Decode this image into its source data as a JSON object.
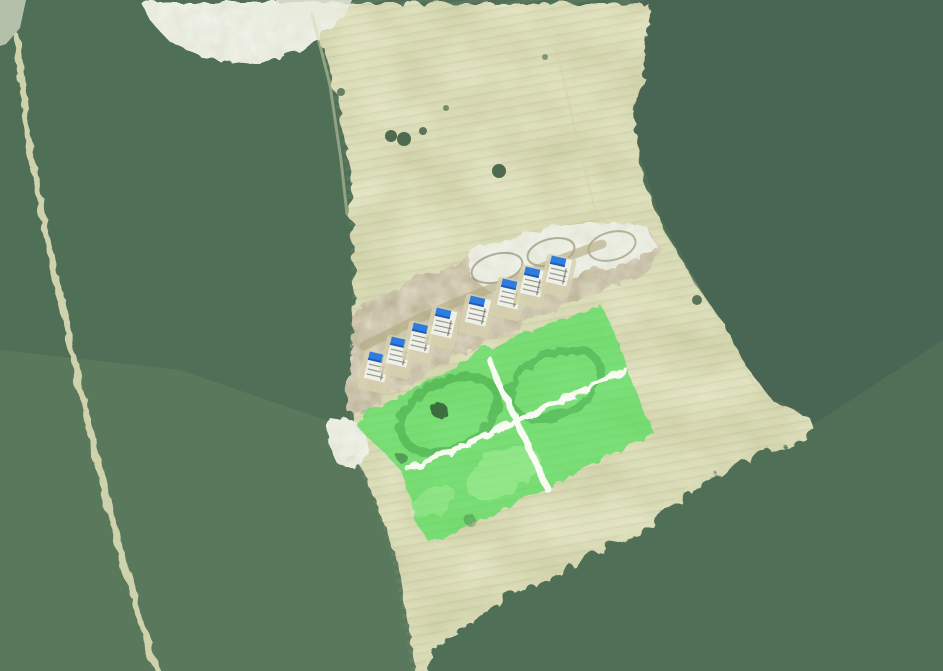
{
  "meta": {
    "view": "aerial-satellite-map",
    "canvas_width": 943,
    "canvas_height": 671
  },
  "palette": {
    "forest_base": "#4f6f57",
    "forest_shadow": "#2e3c49",
    "forest_light": "#93b585",
    "field": "#b0b375",
    "dirt": "#9c8f6b",
    "pale_sand": "#d1d6bf",
    "forest_road": "#d6d8b2",
    "parcel_highlight": "#37e04a",
    "parcel_road_white": "#fdfdf8",
    "house_body": "#eff0e9",
    "house_tarp_blue": "#2d7ce1",
    "house_pad": "#d7d1b0"
  },
  "house_style": {
    "rotation_deg": 13,
    "body_w": 21,
    "body_h": 27,
    "tarp_w": 15,
    "tarp_h": 8.5,
    "pad_w": 30,
    "pad_h": 40,
    "body_fill": "#eff0e9",
    "tarp_fill": "#2d7ce1",
    "tarp_edge": "#1d4f9e",
    "pad_fill": "#d7d1b0",
    "frame_line": "#9a9a8e",
    "dark_line": "#6f6f63"
  },
  "scene": [
    {
      "name": "forest-base",
      "kind": "rect",
      "x": 0,
      "y": 0,
      "w": 943,
      "h": 671,
      "filter": "forestTex",
      "interactable": false
    },
    {
      "name": "forest-tint-northeast",
      "kind": "poly",
      "fill": "rgba(38,56,74,0.15)",
      "interactable": false,
      "points": [
        [
          630,
          0
        ],
        [
          943,
          0
        ],
        [
          943,
          340
        ],
        [
          808,
          428
        ],
        [
          762,
          396
        ],
        [
          716,
          316
        ],
        [
          660,
          216
        ],
        [
          628,
          120
        ],
        [
          638,
          60
        ]
      ]
    },
    {
      "name": "forest-tint-southwest",
      "kind": "poly",
      "fill": "rgba(175,195,135,0.12)",
      "interactable": false,
      "points": [
        [
          0,
          350
        ],
        [
          180,
          370
        ],
        [
          340,
          425
        ],
        [
          400,
          520
        ],
        [
          425,
          671
        ],
        [
          0,
          671
        ]
      ]
    },
    {
      "name": "farm-field",
      "kind": "poly",
      "filter": "fieldTex",
      "clip_id": "fieldClip",
      "interactable": false,
      "points": [
        [
          296,
          0
        ],
        [
          316,
          36
        ],
        [
          334,
          96
        ],
        [
          344,
          156
        ],
        [
          349,
          216
        ],
        [
          352,
          286
        ],
        [
          349,
          356
        ],
        [
          350,
          424
        ],
        [
          348,
          442
        ],
        [
          372,
          498
        ],
        [
          390,
          548
        ],
        [
          400,
          600
        ],
        [
          407,
          640
        ],
        [
          411,
          671
        ],
        [
          424,
          671
        ],
        [
          430,
          645
        ],
        [
          458,
          622
        ],
        [
          505,
          592
        ],
        [
          553,
          570
        ],
        [
          612,
          541
        ],
        [
          650,
          521
        ],
        [
          668,
          505
        ],
        [
          692,
          483
        ],
        [
          726,
          464
        ],
        [
          757,
          450
        ],
        [
          790,
          440
        ],
        [
          815,
          430
        ],
        [
          806,
          414
        ],
        [
          768,
          396
        ],
        [
          740,
          360
        ],
        [
          718,
          317
        ],
        [
          686,
          272
        ],
        [
          664,
          232
        ],
        [
          650,
          205
        ],
        [
          636,
          158
        ],
        [
          630,
          120
        ],
        [
          640,
          72
        ],
        [
          645,
          0
        ]
      ]
    },
    {
      "name": "crop-rows-texture",
      "kind": "rect",
      "x": 0,
      "y": 0,
      "w": 943,
      "h": 671,
      "fill": "url(#cropRows)",
      "clip": "fieldClip",
      "interactable": false
    },
    {
      "name": "sand-clearing",
      "kind": "poly",
      "filter": "paleTex",
      "interactable": false,
      "points": [
        [
          138,
          0
        ],
        [
          342,
          0
        ],
        [
          332,
          22
        ],
        [
          300,
          48
        ],
        [
          258,
          62
        ],
        [
          204,
          57
        ],
        [
          166,
          38
        ],
        [
          146,
          16
        ]
      ]
    },
    {
      "name": "sand-clearing-bright",
      "kind": "poly",
      "fill": "#e9ebdc",
      "opacity": 0.85,
      "interactable": false,
      "points": [
        [
          276,
          0
        ],
        [
          352,
          0
        ],
        [
          344,
          18
        ],
        [
          300,
          30
        ],
        [
          276,
          12
        ]
      ]
    },
    {
      "name": "sand-corner",
      "kind": "poly",
      "fill": "#dfe3cc",
      "opacity": 0.7,
      "interactable": false,
      "points": [
        [
          0,
          0
        ],
        [
          26,
          0
        ],
        [
          20,
          28
        ],
        [
          6,
          44
        ],
        [
          0,
          46
        ]
      ]
    },
    {
      "name": "field-margin-path-west",
      "kind": "line",
      "stroke": "#d4d7ae",
      "w": 3,
      "opacity": 0.5,
      "interactable": false,
      "points": [
        [
          312,
          14
        ],
        [
          330,
          85
        ],
        [
          341,
          160
        ],
        [
          347,
          214
        ]
      ]
    },
    {
      "name": "field-margin-path-east",
      "kind": "line",
      "stroke": "#d0d4a8",
      "w": 2.5,
      "opacity": 0.45,
      "interactable": false,
      "points": [
        [
          652,
          212
        ],
        [
          686,
          270
        ],
        [
          716,
          316
        ],
        [
          754,
          384
        ],
        [
          798,
          434
        ]
      ]
    },
    {
      "name": "construction-access-path",
      "kind": "line",
      "stroke": "#cfd2a6",
      "w": 2.5,
      "opacity": 0.4,
      "interactable": false,
      "points": [
        [
          556,
          48
        ],
        [
          577,
          138
        ],
        [
          596,
          214
        ],
        [
          628,
          238
        ]
      ]
    },
    {
      "name": "forest-dirt-road",
      "kind": "line",
      "stroke": "#d6d8b2",
      "w": 6.5,
      "opacity": 0.95,
      "filter": "roughen",
      "interactable": false,
      "points": [
        [
          14,
          34
        ],
        [
          28,
          150
        ],
        [
          47,
          245
        ],
        [
          67,
          335
        ],
        [
          87,
          425
        ],
        [
          110,
          520
        ],
        [
          132,
          595
        ],
        [
          150,
          655
        ],
        [
          157,
          671
        ]
      ]
    },
    {
      "name": "construction-site-dirt",
      "kind": "poly",
      "filter": "dirtTex",
      "interactable": false,
      "points": [
        [
          352,
          306
        ],
        [
          400,
          282
        ],
        [
          450,
          262
        ],
        [
          504,
          244
        ],
        [
          556,
          230
        ],
        [
          600,
          223
        ],
        [
          644,
          225
        ],
        [
          660,
          246
        ],
        [
          648,
          268
        ],
        [
          606,
          285
        ],
        [
          556,
          305
        ],
        [
          500,
          332
        ],
        [
          446,
          358
        ],
        [
          400,
          384
        ],
        [
          366,
          408
        ],
        [
          348,
          413
        ],
        [
          344,
          396
        ],
        [
          348,
          356
        ],
        [
          350,
          324
        ]
      ]
    },
    {
      "name": "construction-work-area",
      "kind": "poly",
      "filter": "paleTex",
      "interactable": false,
      "points": [
        [
          468,
          248
        ],
        [
          512,
          234
        ],
        [
          560,
          224
        ],
        [
          610,
          220
        ],
        [
          646,
          226
        ],
        [
          656,
          246
        ],
        [
          620,
          262
        ],
        [
          574,
          273
        ],
        [
          528,
          285
        ],
        [
          488,
          290
        ],
        [
          466,
          272
        ]
      ]
    },
    {
      "name": "vehicle-track-loop",
      "kind": "ring",
      "cx": 497,
      "cy": 268,
      "rx": 26,
      "ry": 14,
      "rot": -15,
      "stroke": "rgba(118,108,74,0.5)",
      "w": 2,
      "interactable": false
    },
    {
      "name": "vehicle-track-loop",
      "kind": "ring",
      "cx": 551,
      "cy": 252,
      "rx": 24,
      "ry": 13,
      "rot": -15,
      "stroke": "rgba(118,108,74,0.5)",
      "w": 2,
      "interactable": false
    },
    {
      "name": "vehicle-track-loop",
      "kind": "ring",
      "cx": 612,
      "cy": 246,
      "rx": 24,
      "ry": 14,
      "rot": -15,
      "stroke": "rgba(118,108,74,0.45)",
      "w": 2,
      "interactable": false
    },
    {
      "name": "construction-street",
      "kind": "line",
      "stroke": "#b3a87e",
      "w": 9,
      "opacity": 0.6,
      "interactable": false,
      "points": [
        [
          364,
          346
        ],
        [
          420,
          318
        ],
        [
          472,
          296
        ],
        [
          522,
          276
        ],
        [
          564,
          258
        ],
        [
          602,
          244
        ]
      ]
    },
    {
      "name": "house",
      "kind": "house",
      "cx": 377,
      "cy": 367,
      "interactable": false
    },
    {
      "name": "house",
      "kind": "house",
      "cx": 399,
      "cy": 352,
      "interactable": false
    },
    {
      "name": "house",
      "kind": "house",
      "cx": 421,
      "cy": 338,
      "interactable": false
    },
    {
      "name": "house",
      "kind": "house",
      "cx": 444,
      "cy": 323,
      "interactable": false
    },
    {
      "name": "house",
      "kind": "house",
      "cx": 478,
      "cy": 311,
      "interactable": false
    },
    {
      "name": "house",
      "kind": "house",
      "cx": 510,
      "cy": 294,
      "interactable": false
    },
    {
      "name": "house",
      "kind": "house",
      "cx": 533,
      "cy": 282,
      "interactable": false
    },
    {
      "name": "house",
      "kind": "house",
      "cx": 559,
      "cy": 271,
      "interactable": false
    },
    {
      "name": "west-dirt-patch",
      "kind": "poly",
      "filter": "paleTex",
      "interactable": false,
      "points": [
        [
          326,
          414
        ],
        [
          352,
          418
        ],
        [
          364,
          432
        ],
        [
          368,
          452
        ],
        [
          352,
          466
        ],
        [
          334,
          460
        ],
        [
          325,
          436
        ]
      ]
    },
    {
      "name": "site-container",
      "kind": "box",
      "x": 333,
      "y": 446,
      "w": 9,
      "h": 5,
      "rot": -20,
      "fill": "#e9e7d8",
      "interactable": false
    },
    {
      "name": "site-container",
      "kind": "box",
      "x": 346,
      "y": 456,
      "w": 9,
      "h": 5,
      "rot": -20,
      "fill": "#e4e2d2",
      "interactable": false
    },
    {
      "name": "highlighted-parcel",
      "kind": "group",
      "filter": "roughen",
      "interactable": true,
      "children": [
        {
          "name": "parcel-highlight-fill",
          "kind": "poly",
          "fill": "#37e04a",
          "opacity": 0.6,
          "interactable": false,
          "points": [
            [
              371,
              407
            ],
            [
              424,
              379
            ],
            [
              476,
              351
            ],
            [
              524,
              330
            ],
            [
              572,
              312
            ],
            [
              598,
              302
            ],
            [
              612,
              330
            ],
            [
              634,
              390
            ],
            [
              652,
              431
            ],
            [
              601,
              457
            ],
            [
              548,
              484
            ],
            [
              494,
              510
            ],
            [
              438,
              536
            ],
            [
              425,
              538
            ],
            [
              414,
              520
            ],
            [
              407,
              492
            ],
            [
              398,
              468
            ],
            [
              384,
              452
            ],
            [
              362,
              432
            ],
            [
              354,
              423
            ],
            [
              360,
              414
            ]
          ]
        },
        {
          "name": "parcel-grass-patch",
          "kind": "ellipse",
          "cx": 500,
          "cy": 470,
          "rx": 40,
          "ry": 22,
          "rot": -27,
          "fill": "rgba(215,255,190,0.28)",
          "interactable": false
        },
        {
          "name": "parcel-grass-patch",
          "kind": "ellipse",
          "cx": 430,
          "cy": 500,
          "rx": 25,
          "ry": 14,
          "rot": -27,
          "fill": "rgba(215,255,190,0.22)",
          "interactable": false
        },
        {
          "name": "parcel-ground-ring",
          "kind": "ring",
          "cx": 447,
          "cy": 412,
          "rx": 52,
          "ry": 33,
          "rot": -27,
          "stroke": "rgba(35,125,45,0.32)",
          "w": 9,
          "interactable": false
        },
        {
          "name": "parcel-ground-ring",
          "kind": "ring",
          "cx": 553,
          "cy": 382,
          "rx": 48,
          "ry": 30,
          "rot": -27,
          "stroke": "rgba(35,125,45,0.30)",
          "w": 8,
          "interactable": false
        },
        {
          "name": "parcel-tree",
          "kind": "circle",
          "cx": 437,
          "cy": 408,
          "r": 8,
          "fill": "#2f5c36",
          "opacity": 0.85,
          "interactable": false
        },
        {
          "name": "parcel-shrub",
          "kind": "circle",
          "cx": 400,
          "cy": 456,
          "r": 5,
          "fill": "#2f5c36",
          "opacity": 0.5,
          "interactable": false
        },
        {
          "name": "parcel-shrub",
          "kind": "circle",
          "cx": 468,
          "cy": 518,
          "r": 6,
          "fill": "#3a6b40",
          "opacity": 0.35,
          "interactable": false
        },
        {
          "name": "parcel-road-northeast",
          "kind": "line",
          "stroke": "#fdfdf8",
          "w": 6.5,
          "opacity": 0.96,
          "interactable": false,
          "points": [
            [
              622,
              368
            ],
            [
              408,
              468
            ]
          ]
        },
        {
          "name": "parcel-road-southeast",
          "kind": "line",
          "stroke": "#fdfdf8",
          "w": 6.5,
          "opacity": 0.96,
          "interactable": false,
          "points": [
            [
              487,
              357
            ],
            [
              545,
              487
            ]
          ]
        }
      ]
    },
    {
      "name": "field-tree",
      "kind": "circle",
      "cx": 391,
      "cy": 136,
      "r": 6,
      "fill": "#3c5a41",
      "opacity": 0.88,
      "interactable": false
    },
    {
      "name": "field-tree",
      "kind": "circle",
      "cx": 404,
      "cy": 139,
      "r": 7,
      "fill": "#3c5a41",
      "opacity": 0.88,
      "interactable": false
    },
    {
      "name": "field-tree",
      "kind": "circle",
      "cx": 423,
      "cy": 131,
      "r": 4,
      "fill": "#3c5a41",
      "opacity": 0.8,
      "interactable": false
    },
    {
      "name": "field-tree",
      "kind": "circle",
      "cx": 499,
      "cy": 171,
      "r": 7,
      "fill": "#3c5a41",
      "opacity": 0.88,
      "interactable": false
    },
    {
      "name": "field-tree",
      "kind": "circle",
      "cx": 341,
      "cy": 92,
      "r": 4,
      "fill": "#4a6a4e",
      "opacity": 0.8,
      "interactable": false
    },
    {
      "name": "field-tree",
      "kind": "circle",
      "cx": 446,
      "cy": 108,
      "r": 3,
      "fill": "#4a6a4e",
      "opacity": 0.7,
      "interactable": false
    },
    {
      "name": "field-tree",
      "kind": "circle",
      "cx": 545,
      "cy": 57,
      "r": 3,
      "fill": "#4a6a4e",
      "opacity": 0.6,
      "interactable": false
    },
    {
      "name": "field-tree",
      "kind": "circle",
      "cx": 697,
      "cy": 300,
      "r": 5,
      "fill": "#3c5a41",
      "opacity": 0.8,
      "interactable": false
    }
  ]
}
